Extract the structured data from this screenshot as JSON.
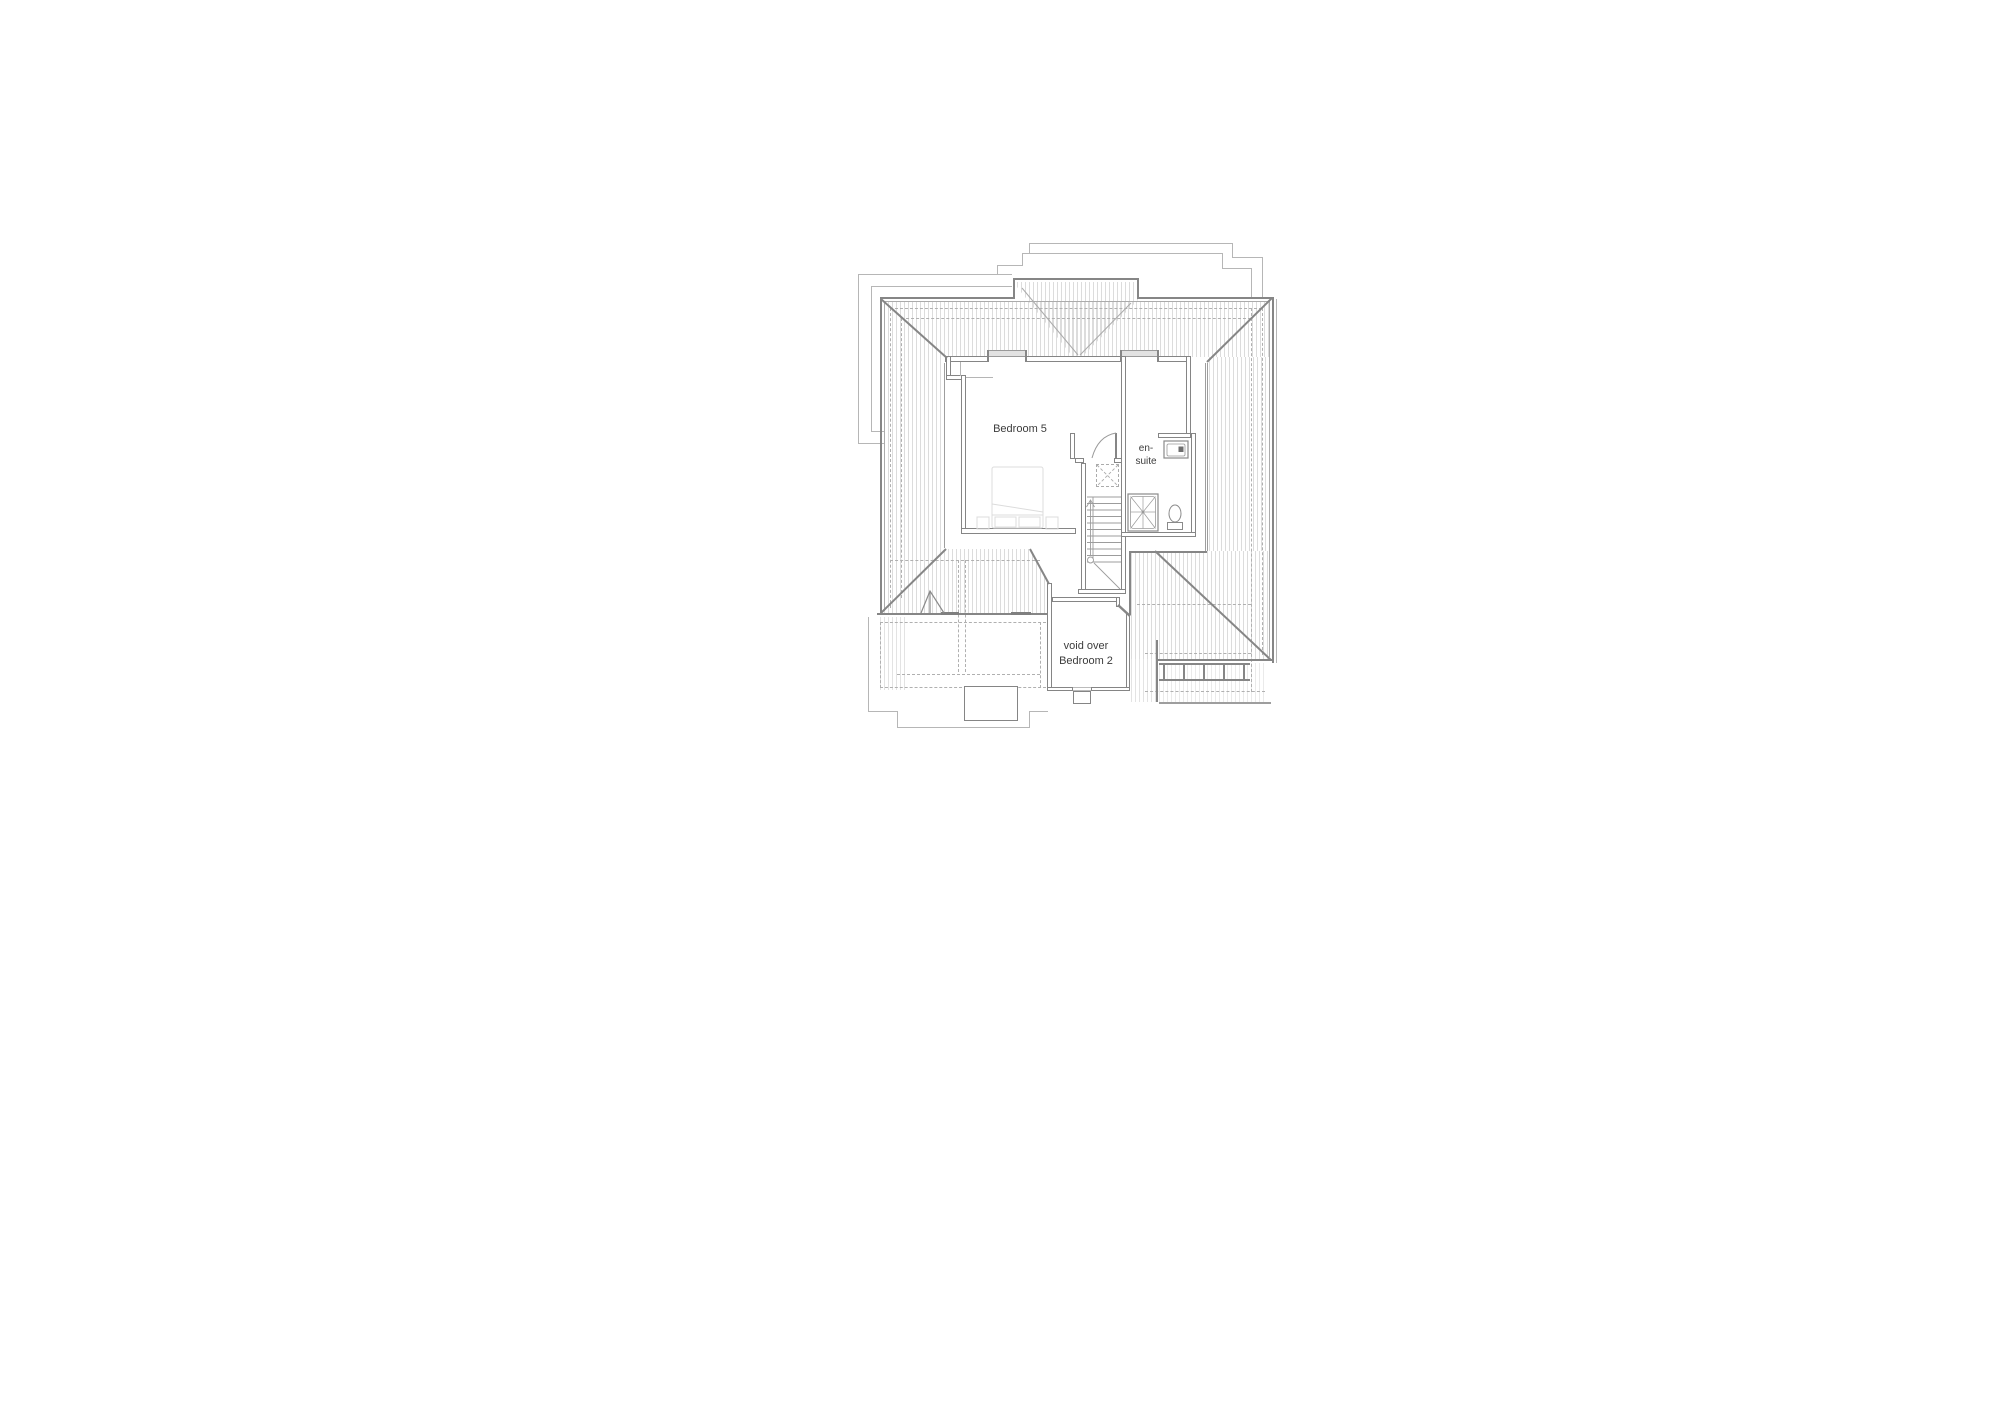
{
  "plan": {
    "labels": {
      "bedroom5": "Bedroom 5",
      "ensuite_line1": "en-",
      "ensuite_line2": "suite",
      "void_line1": "void over",
      "void_line2": "Bedroom 2"
    },
    "colors": {
      "wall_line": "#868686",
      "roof_hatch": "#dcdcdc",
      "dashed_line": "#b0b0b0",
      "thin_outline": "#b6b6b6",
      "text": "#3c3c3c",
      "glazing": "#e2e2e2",
      "background": "#ffffff"
    }
  }
}
